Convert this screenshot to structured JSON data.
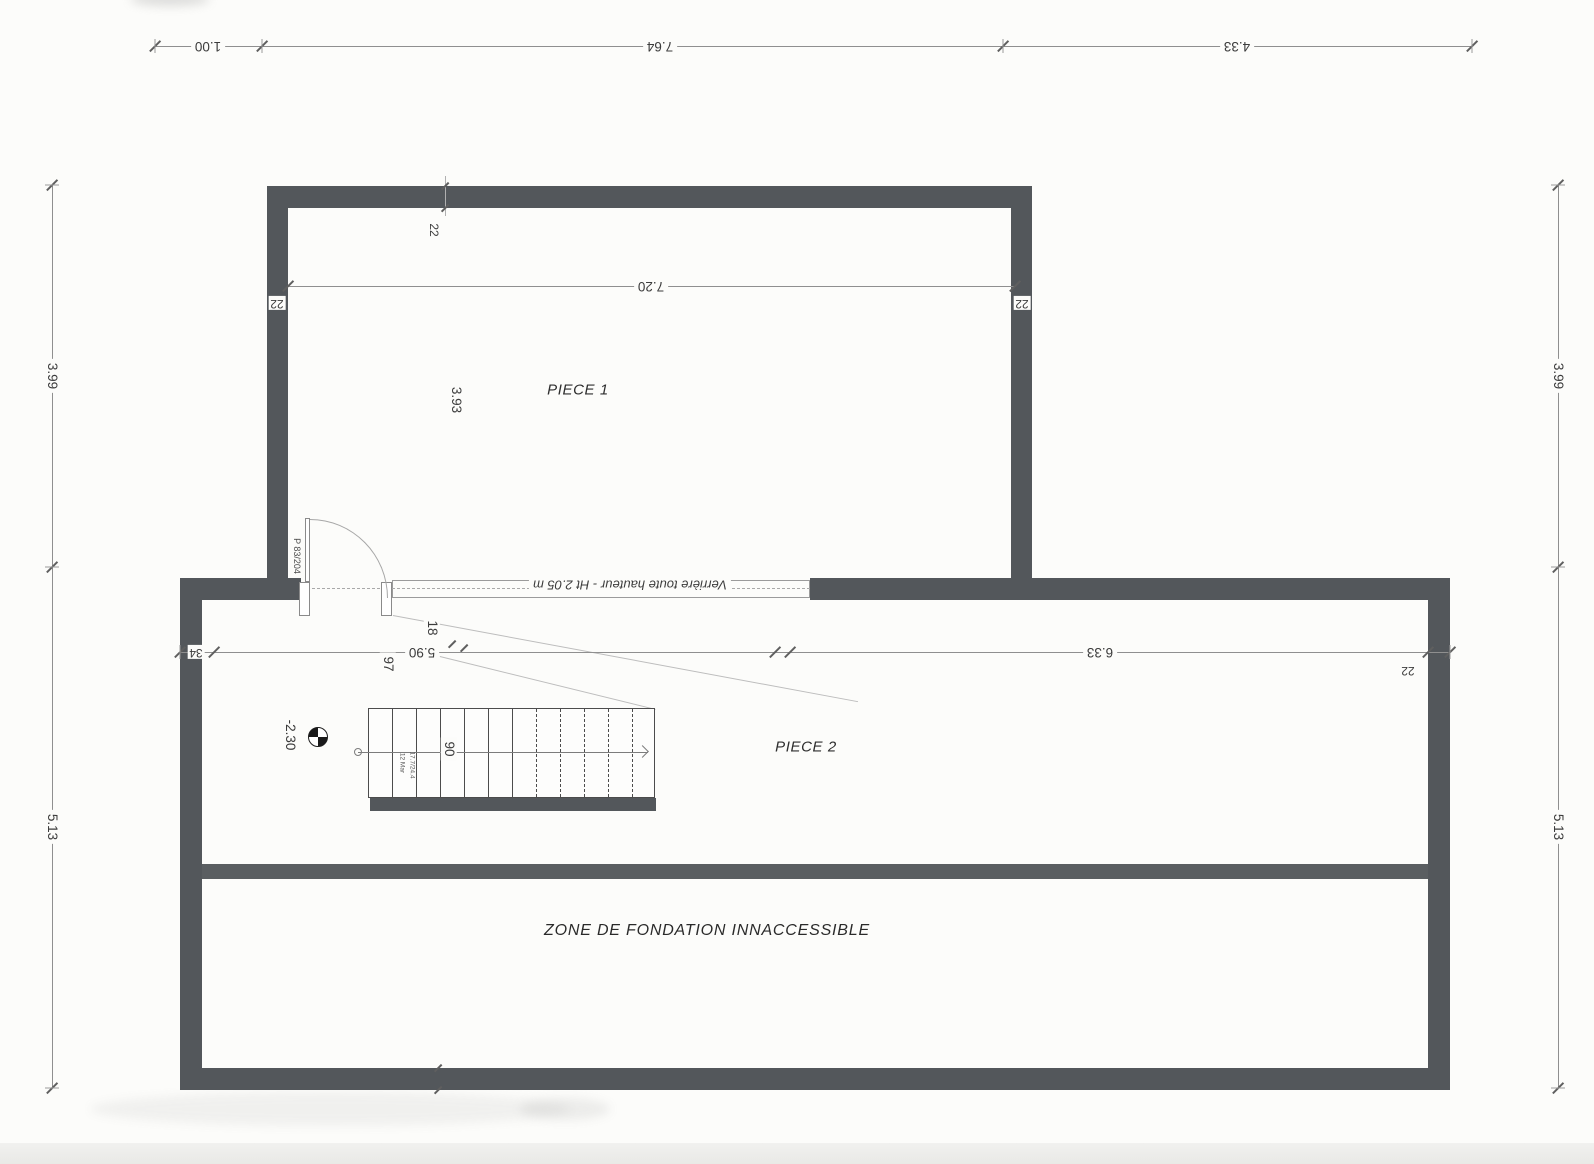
{
  "labels": {
    "room1": "PIECE 1",
    "room2": "PIECE 2",
    "foundation_zone": "ZONE  DE FONDATION INNACCESSIBLE",
    "glazing_note": "Verrière toute hauteur - Ht 2.05 m",
    "door": "P 83/204",
    "level_value": "-2.30",
    "stair_note_line1": "12 Mar",
    "stair_note_line2": "17.7/24.4"
  },
  "dimensions": {
    "top": [
      "1.00",
      "7.64",
      "4.33"
    ],
    "side_upper": "3.99",
    "side_lower": "5.13",
    "room1_interior_width": "7.20",
    "room1_interior_depth": "3.93",
    "wall_thickness_top": "22",
    "wall_thickness_left": "22",
    "wall_thickness_right": "22",
    "wall_thickness_lower_right": "22",
    "lower_left_wall": "34",
    "lower_left_span": "5.90",
    "lower_right_span": "6.33",
    "glazing_thickness": "18",
    "stair_start_offset": "97",
    "stair_width": "90"
  },
  "colors": {
    "wall": "#53575b",
    "dim_line": "#8f8f8f",
    "text": "#3c3c3c",
    "background": "#fcfcfa"
  }
}
